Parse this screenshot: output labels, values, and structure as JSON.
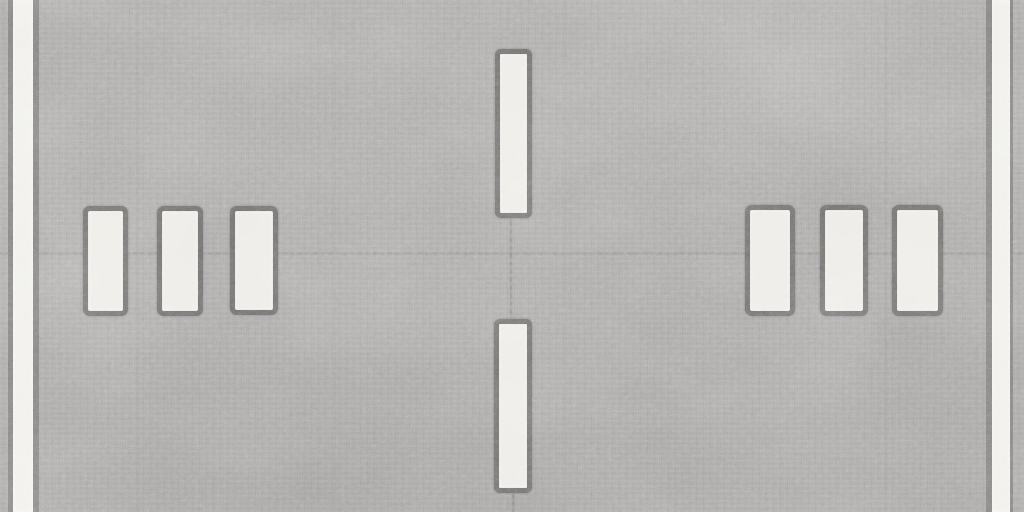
{
  "scene": {
    "description": "Top-down seamless asphalt road texture tile with painted white markings",
    "width_px": 1024,
    "height_px": 512,
    "colors": {
      "asphalt": "#a9a7a6",
      "asphalt_light": "#b6b4b3",
      "asphalt_dark": "#989694",
      "paint": "#edebe6",
      "paint_bright": "#f0efeb",
      "outline": "#6e6c6b",
      "edge_border": "#7f7d7c",
      "seam": "#6f6d6b"
    },
    "edge_lines": [
      {
        "name": "left-edge-line",
        "x": 8,
        "y": 0,
        "width": 31,
        "height": 512,
        "border_left": 5,
        "border_right": 6
      },
      {
        "name": "right-edge-line",
        "x": 986,
        "y": 0,
        "width": 27,
        "height": 512,
        "border_left": 6,
        "border_right": 3
      }
    ],
    "markings": [
      {
        "name": "center-dash-top",
        "kind": "dash",
        "x": 495,
        "y": 49,
        "width": 37,
        "height": 169
      },
      {
        "name": "center-dash-bottom",
        "kind": "dash",
        "x": 494,
        "y": 319,
        "width": 38,
        "height": 174
      },
      {
        "name": "bar-left-1",
        "kind": "bar",
        "x": 83,
        "y": 206,
        "width": 45,
        "height": 110
      },
      {
        "name": "bar-left-2",
        "kind": "bar",
        "x": 157,
        "y": 206,
        "width": 46,
        "height": 110
      },
      {
        "name": "bar-left-3",
        "kind": "bar",
        "x": 230,
        "y": 206,
        "width": 48,
        "height": 109
      },
      {
        "name": "bar-right-1",
        "kind": "bar",
        "x": 745,
        "y": 205,
        "width": 50,
        "height": 111
      },
      {
        "name": "bar-right-2",
        "kind": "bar",
        "x": 820,
        "y": 205,
        "width": 48,
        "height": 111
      },
      {
        "name": "bar-right-3",
        "kind": "bar",
        "x": 892,
        "y": 205,
        "width": 51,
        "height": 111
      }
    ],
    "surface_features": {
      "horizontal_seam": {
        "y": 252,
        "height": 3
      },
      "vertical_streaks": [
        {
          "x": 137,
          "opacity": 0.08
        },
        {
          "x": 334,
          "opacity": 0.05
        },
        {
          "x": 565,
          "opacity": 0.06
        },
        {
          "x": 885,
          "opacity": 0.08
        }
      ],
      "cracks": [
        {
          "x": 510,
          "y": 218,
          "width": 2,
          "height": 102
        },
        {
          "x": 512,
          "y": 493,
          "width": 2,
          "height": 19
        }
      ]
    }
  }
}
